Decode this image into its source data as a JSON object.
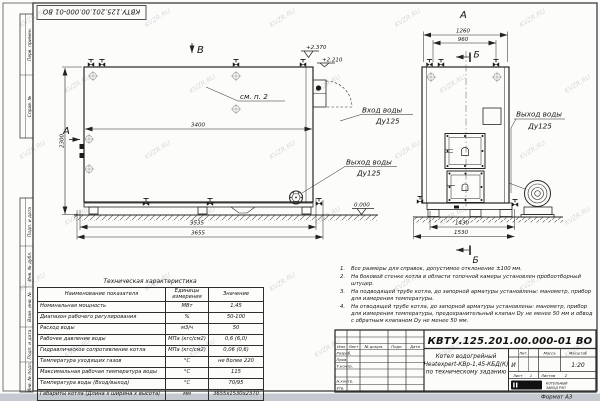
{
  "sheet": {
    "format_note": "Формат  А3",
    "watermark": "KVZR.RU"
  },
  "frame": {
    "stamp_top": "КВТУ.125.201.00.000-01  ВО",
    "left_top": [
      "Перв. примен.",
      "Справ. №"
    ],
    "left_bottom": [
      "Подп. и дата",
      "Инв. № дубл.",
      "Взам. инв. №",
      "Подп. и дата",
      "Инв. № подл."
    ]
  },
  "drawing": {
    "view_b_label": "В",
    "view_a_label": "А",
    "front_view_title": "А",
    "section_label_top": "Б",
    "section_label_bottom": "Б",
    "callout_note2": "см. п. 2",
    "labels": {
      "inlet_line1": "Вход воды",
      "inlet_line2": "Ду125",
      "outlet_line1": "Выход воды",
      "outlet_line2": "Ду125",
      "front_outlet_line1": "Выход воды",
      "front_outlet_line2": "Ду125"
    },
    "dims": {
      "d2300": "2300",
      "d3400": "3400",
      "d3535": "3535",
      "d3655": "3655",
      "d1260": "1260",
      "d960": "960",
      "d1430": "1430",
      "d1530": "1530",
      "e2370": "+2.370",
      "e2210": "+2.210",
      "e0000": "0.000"
    }
  },
  "tech_table": {
    "title": "Техническая характеристика",
    "headers": [
      "Наименование показателя",
      "Единицы измерения",
      "Значение"
    ],
    "rows": [
      [
        "Номинальная мощность",
        "МВт",
        "1,45"
      ],
      [
        "Диапазон рабочего регулирования",
        "%",
        "50-100"
      ],
      [
        "Расход воды",
        "м3/ч",
        "50"
      ],
      [
        "Рабочее давление воды",
        "МПа (кгс/см2)",
        "0,6 (6,0)"
      ],
      [
        "Гидравлическое сопротивление котла",
        "МПа (кгс/см2)",
        "0,06 (0,6)"
      ],
      [
        "Температура уходящих газов",
        "°С",
        "не более 220"
      ],
      [
        "Максимальная рабочая температура воды",
        "°С",
        "115"
      ],
      [
        "Температура воды (Вход/выход)",
        "°С",
        "70/95"
      ],
      [
        "Габариты котла (Длина х ширина х высота)",
        "мм",
        "3655х1530х2370"
      ]
    ]
  },
  "notes": {
    "items": [
      "Все размеры для справок, допустимое отклонение ±100 мм.",
      "На боковой стенке котла в области топочной камеры установлен пробоотборный штуцер.",
      "На подводящей трубе котла, до запорной арматуры установлены: манометр, прибор для измерения температуры.",
      "На отводящей трубе котла, до запорной арматуры установлены: манометр, прибор для измерения температуры, предохранительный клапан Dу не менее 50 мм и обвод с обратным клапаном Dу не менее 50 мм."
    ]
  },
  "title_block": {
    "designation": "КВТУ.125.201.00.000-01  ВО",
    "name_line1": "Котел водогрейный",
    "name_line2": "Heatexpert-КВр-1,45-КБД(К)",
    "name_line3": "по техническому заданию",
    "col_izm": "Изм",
    "col_list": "Лист",
    "col_doc": "№ докум.",
    "col_podp": "Подп.",
    "col_data": "Дата",
    "row_razrab": "Разраб.",
    "row_prov": "Пров.",
    "row_tkontr": "Т.контр.",
    "row_nkontr": "Н.контр.",
    "row_utv": "Утв.",
    "lit_label": "Лит.",
    "lit_value": "И",
    "mass_label": "Масса",
    "scale_label": "Масштаб",
    "scale_value": "1:20",
    "sheet_label": "Лист",
    "sheet_value": "1",
    "sheets_label": "Листов",
    "sheets_value": "2",
    "logo_text": "KVZR",
    "company_line1": "КОТЕЛЬНЫЙ",
    "company_line2": "ЗАВОД РЭП"
  }
}
